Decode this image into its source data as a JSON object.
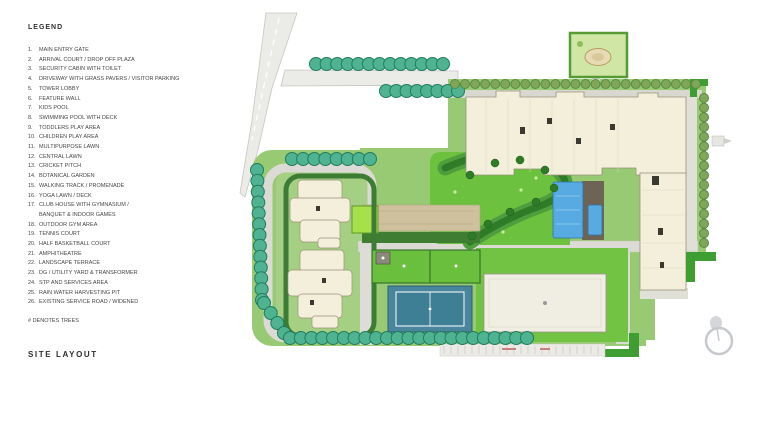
{
  "document": {
    "title": "SITE LAYOUT"
  },
  "legend": {
    "heading": "LEGEND",
    "note": "# DENOTES TREES",
    "items": [
      {
        "no": "1.",
        "label": "MAIN ENTRY GATE"
      },
      {
        "no": "2.",
        "label": "ARRIVAL COURT / DROP OFF PLAZA"
      },
      {
        "no": "3.",
        "label": "SECURITY CABIN WITH TOILET"
      },
      {
        "no": "4.",
        "label": "DRIVEWAY WITH GRASS PAVERS / VISITOR PARKING"
      },
      {
        "no": "5.",
        "label": "TOWER LOBBY"
      },
      {
        "no": "6.",
        "label": "FEATURE WALL"
      },
      {
        "no": "7.",
        "label": "KIDS POOL"
      },
      {
        "no": "8.",
        "label": "SWIMMING POOL WITH DECK"
      },
      {
        "no": "9.",
        "label": "TODDLERS PLAY AREA"
      },
      {
        "no": "10.",
        "label": "CHILDREN PLAY AREA"
      },
      {
        "no": "11.",
        "label": "MULTIPURPOSE LAWN"
      },
      {
        "no": "12.",
        "label": "CENTRAL LAWN"
      },
      {
        "no": "13.",
        "label": "CRICKET PITCH"
      },
      {
        "no": "14.",
        "label": "BOTANICAL GARDEN"
      },
      {
        "no": "15.",
        "label": "WALKING TRACK / PROMENADE"
      },
      {
        "no": "16.",
        "label": "YOGA LAWN / DECK"
      },
      {
        "no": "17.",
        "label": "CLUB HOUSE WITH GYMNASIUM /",
        "label2": "BANQUET & INDOOR GAMES"
      },
      {
        "no": "18.",
        "label": "OUTDOOR GYM AREA"
      },
      {
        "no": "19.",
        "label": "TENNIS COURT"
      },
      {
        "no": "20.",
        "label": "HALF BASKETBALL COURT"
      },
      {
        "no": "21.",
        "label": "AMPHITHEATRE"
      },
      {
        "no": "22.",
        "label": "LANDSCAPE TERRACE"
      },
      {
        "no": "23.",
        "label": "DG / UTILITY YARD & TRANSFORMER"
      },
      {
        "no": "24.",
        "label": "STP AND SERVICES AREA"
      },
      {
        "no": "25.",
        "label": "RAIN WATER HARVESTING PIT"
      },
      {
        "no": "26.",
        "label": "EXISTING SERVICE ROAD / WIDENED"
      }
    ]
  },
  "plan": {
    "features": [
      "access-road",
      "entry-drive",
      "perimeter-hedge",
      "tree-row",
      "residential-tower-east",
      "residential-towers-west",
      "swimming-pool",
      "kids-pool",
      "pool-deck",
      "central-lawn",
      "walking-track-band",
      "tennis-court",
      "sports-lawn",
      "club-house",
      "utility-plot",
      "parking-strip",
      "north-arrow"
    ],
    "colors": {
      "hedge_teal": "#4fb392",
      "hedge_teal_dark": "#1f7d5e",
      "site_green": "#97ca72",
      "lawn_green": "#6cc23f",
      "dark_hedge": "#2e7b28",
      "corner_green": "#3f9e31",
      "building_cream": "#f4efdb",
      "building_outline": "#96937a",
      "pool_blue": "#58aae2",
      "tennis_blue": "#44809a",
      "road_grey": "#ebebe8",
      "deck_tan": "#cfc19d",
      "lime_feature": "#a6e14b",
      "utility_border": "#569b33"
    }
  }
}
